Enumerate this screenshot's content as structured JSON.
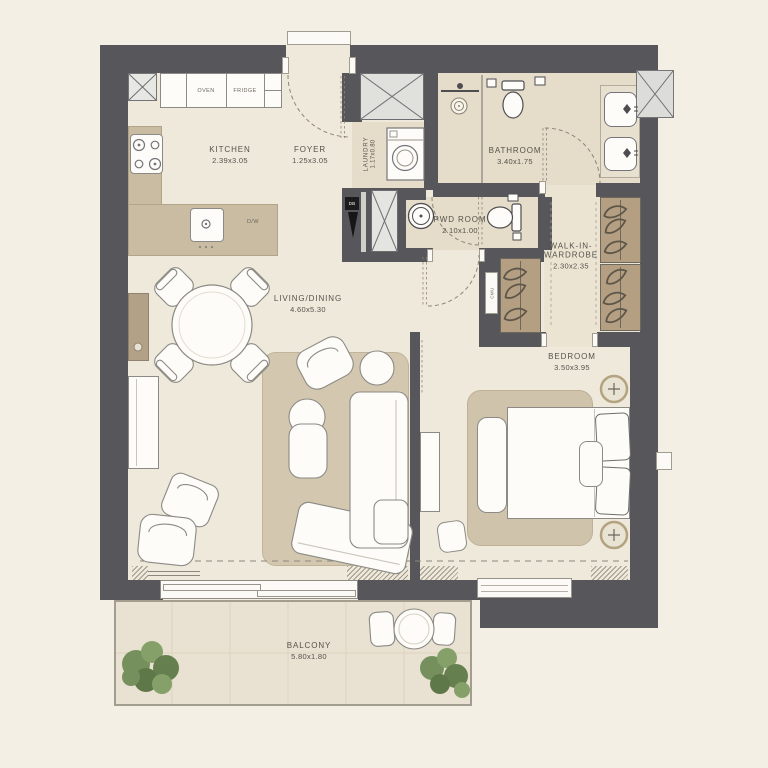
{
  "rooms": {
    "kitchen": {
      "name": "KITCHEN",
      "dims": "2.39x3.05"
    },
    "foyer": {
      "name": "FOYER",
      "dims": "1.25x3.05"
    },
    "laundry": {
      "name": "LAUNDRY",
      "dims": "1.17x0.80"
    },
    "bathroom": {
      "name": "BATHROOM",
      "dims": "3.40x1.75"
    },
    "powder_room": {
      "name": "PWD ROOM",
      "dims": "2.10x1.00"
    },
    "walk_in_wardrobe": {
      "name_line1": "WALK-IN-",
      "name_line2": "WARDROBE",
      "dims": "2.30x2.35"
    },
    "living_dining": {
      "name": "LIVING/DINING",
      "dims": "4.60x5.30"
    },
    "bedroom": {
      "name": "BEDROOM",
      "dims": "3.50x3.95"
    },
    "balcony": {
      "name": "BALCONY",
      "dims": "5.80x1.80"
    }
  },
  "labels": {
    "oven": "OVEN",
    "fridge": "FRIDGE",
    "dishwasher": "D/W",
    "distribution_board": "DB",
    "duct": "CMU"
  },
  "colors": {
    "wall": "#57565a",
    "floor": "#efe9db",
    "wet_floor": "#e5dcc9",
    "counter": "#c9bca3",
    "wardrobe_unit": "#b49f83",
    "rug": "#cfc3ab",
    "balcony_floor": "#e9e1d1",
    "plant_green": "#75905c",
    "background": "#f4efe4"
  }
}
